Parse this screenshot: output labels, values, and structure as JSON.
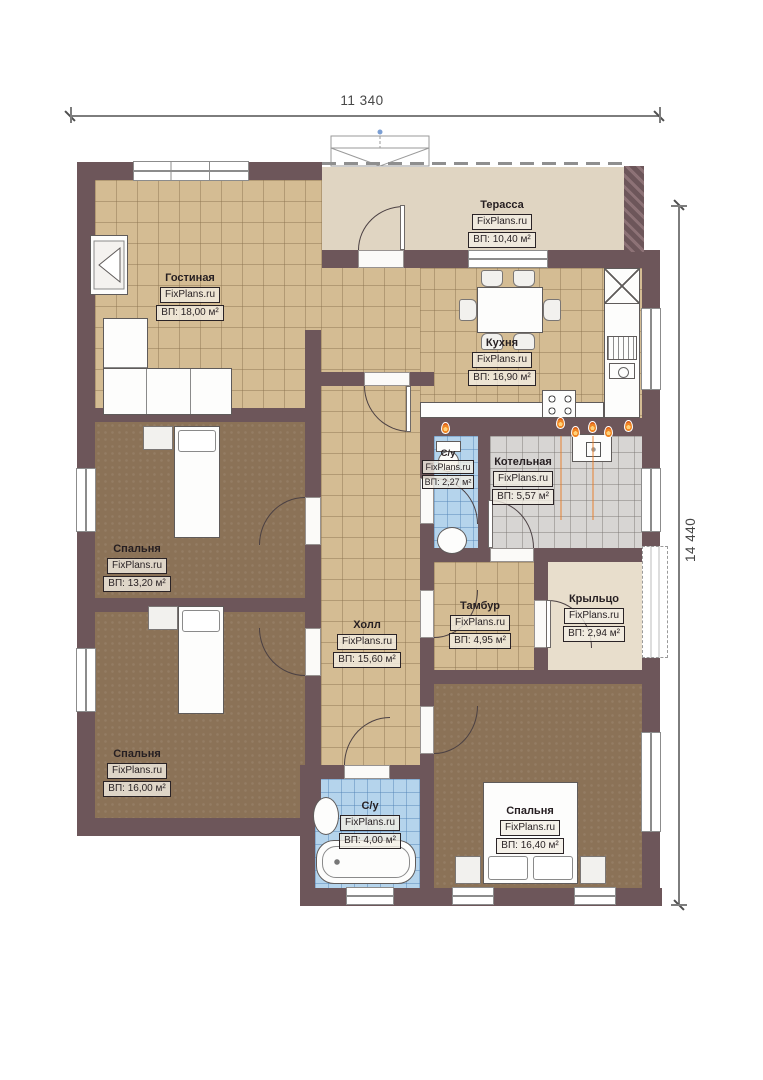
{
  "plan": {
    "title": "Одноэтажный дом — план",
    "branding": "FixPlans.ru",
    "dimensions": {
      "width_label": "11 340",
      "height_label": "14 440"
    },
    "rooms": [
      {
        "key": "terrace",
        "name": "Терасса",
        "area": "ВП: 10,40 м²"
      },
      {
        "key": "living",
        "name": "Гостиная",
        "area": "ВП: 18,00 м²"
      },
      {
        "key": "kitchen",
        "name": "Кухня",
        "area": "ВП: 16,90 м²"
      },
      {
        "key": "wc",
        "name": "С/у",
        "area": "ВП: 2,27 м²"
      },
      {
        "key": "boiler",
        "name": "Котельная",
        "area": "ВП: 5,57 м²"
      },
      {
        "key": "bedroom1",
        "name": "Спальня",
        "area": "ВП: 13,20 м²"
      },
      {
        "key": "hall",
        "name": "Холл",
        "area": "ВП: 15,60 м²"
      },
      {
        "key": "tambour",
        "name": "Тамбур",
        "area": "ВП: 4,95 м²"
      },
      {
        "key": "porch",
        "name": "Крыльцо",
        "area": "ВП: 2,94 м²"
      },
      {
        "key": "bedroom2",
        "name": "Спальня",
        "area": "ВП: 16,00 м²"
      },
      {
        "key": "bathroom",
        "name": "С/у",
        "area": "ВП: 4,00 м²"
      },
      {
        "key": "bedroom3",
        "name": "Спальня",
        "area": "ВП: 16,40 м²"
      }
    ],
    "colors": {
      "wall": "#6d565a",
      "floor_tile_tan": "#d4bc93",
      "floor_carpet_brown": "#8b7257",
      "floor_wet_blue": "#b5d4ec",
      "floor_boiler_gray": "#d7d5d3",
      "terrace_beige": "#e0d5c2",
      "gas_flame_orange": "#f08624"
    }
  }
}
